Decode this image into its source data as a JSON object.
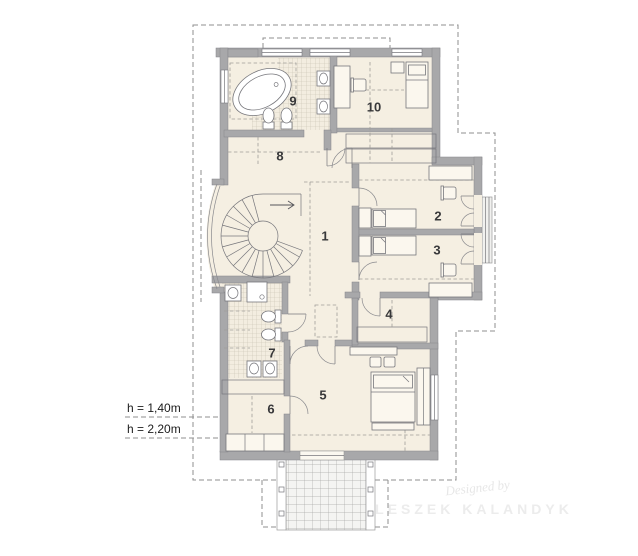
{
  "plan": {
    "kind": "architectural-floor-plan-attic"
  },
  "rooms": [
    {
      "number": "1"
    },
    {
      "number": "2"
    },
    {
      "number": "3"
    },
    {
      "number": "4"
    },
    {
      "number": "5"
    },
    {
      "number": "6"
    },
    {
      "number": "7"
    },
    {
      "number": "8"
    },
    {
      "number": "9"
    },
    {
      "number": "10"
    }
  ],
  "annotations": {
    "height_labels": [
      "h = 1,40m",
      "h = 2,20m"
    ]
  },
  "watermark": {
    "prefix": "Designed by",
    "name": "LESZEK KALANDYK"
  },
  "colors": {
    "wall": "#a8a8aa",
    "floor": "#f5efe2",
    "tile_floor": "#f3ede0",
    "outline": "#77777c",
    "dashed": "#9a9a9a",
    "number_text": "#38383a",
    "label_text": "#1c1c1c",
    "watermark": "#e7e7e7",
    "terrace": "#f4f4f2"
  },
  "furniture_icons": [
    "spiral-staircase",
    "bathtub",
    "toilet",
    "washbasin",
    "sink",
    "shower",
    "bed",
    "nightstand",
    "desk",
    "chair",
    "wardrobe-hatch",
    "shelf",
    "pouf",
    "bench",
    "terrace-grid",
    "balcony-railing",
    "door-arc",
    "window"
  ]
}
